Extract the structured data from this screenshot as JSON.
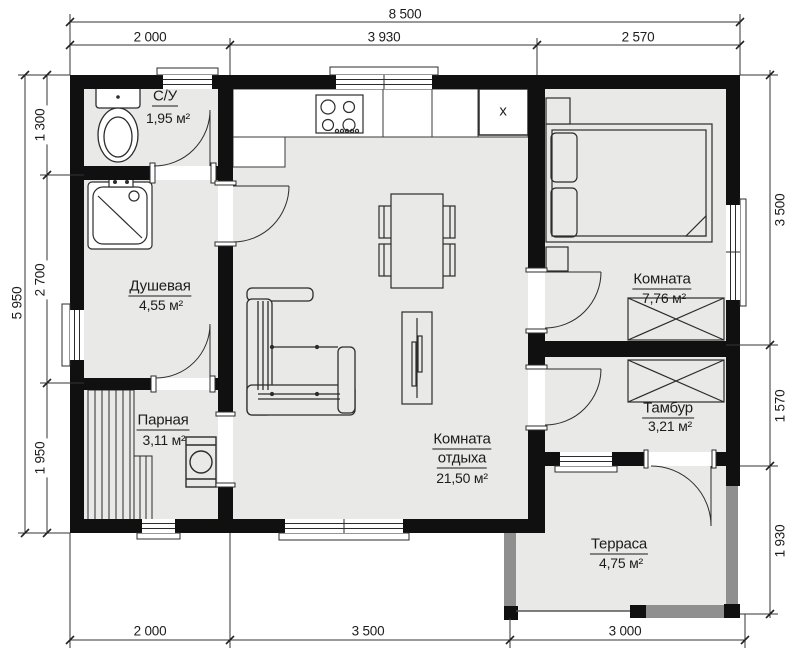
{
  "plan": {
    "dimensions": {
      "top_total": "8 500",
      "top": [
        "2 000",
        "3 930",
        "2 570"
      ],
      "left_total": "5 950",
      "left": [
        "1 300",
        "2 700",
        "1 950"
      ],
      "right": [
        "3 500",
        "1 570",
        "1 930"
      ],
      "bottom": [
        "2 000",
        "3 500",
        "3 000"
      ]
    },
    "rooms": {
      "wc": {
        "name": "С/У",
        "area": "1,95 м²"
      },
      "shower": {
        "name": "Душевая",
        "area": "4,55 м²"
      },
      "sauna": {
        "name": "Парная",
        "area": "3,11 м²"
      },
      "lounge": {
        "name_line1": "Комната",
        "name_line2": "отдыха",
        "area": "21,50 м²"
      },
      "bedroom": {
        "name": "Комната",
        "area": "7,76 м²"
      },
      "vestibule": {
        "name": "Тамбур",
        "area": "3,21 м²"
      },
      "terrace": {
        "name": "Терраса",
        "area": "4,75 м²"
      }
    },
    "markers": {
      "kitchen_x": "x"
    }
  }
}
